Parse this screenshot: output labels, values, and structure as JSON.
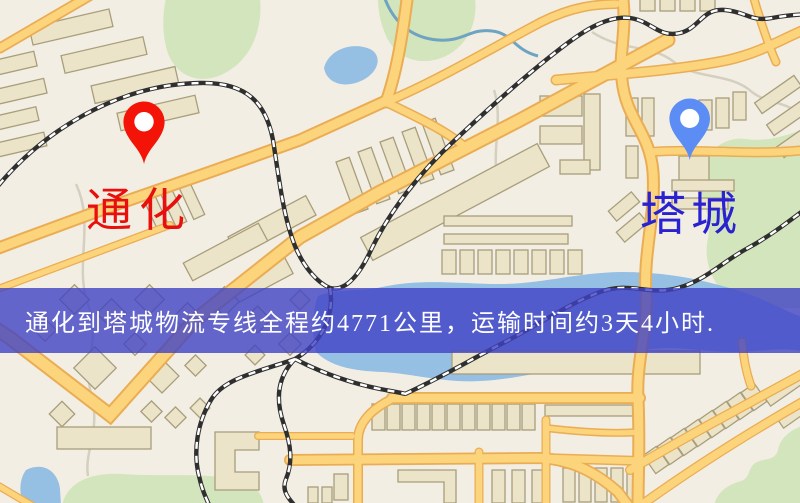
{
  "banner": {
    "text": "通化到塔城物流专线全程约4771公里，运输时间约3天4小时.",
    "background_color": "#4042c4",
    "text_color": "#ffffff"
  },
  "markers": {
    "origin": {
      "name": "通化",
      "label_color": "#e8100c",
      "pin_color": "#ee1509"
    },
    "destination": {
      "name": "塔城",
      "label_color": "#2a22d0",
      "pin_color": "#5d8df2"
    }
  },
  "route_info": {
    "distance": "约4771公里",
    "duration": "约3天4小时"
  },
  "map_palette": {
    "background": "#f3eee3",
    "road_fill": "#fbd47f",
    "road_casing": "#e8ad57",
    "park": "#d3e5bd",
    "water": "#96bfe2",
    "building": "#ece4c9",
    "railway": "#2f2f2f"
  }
}
